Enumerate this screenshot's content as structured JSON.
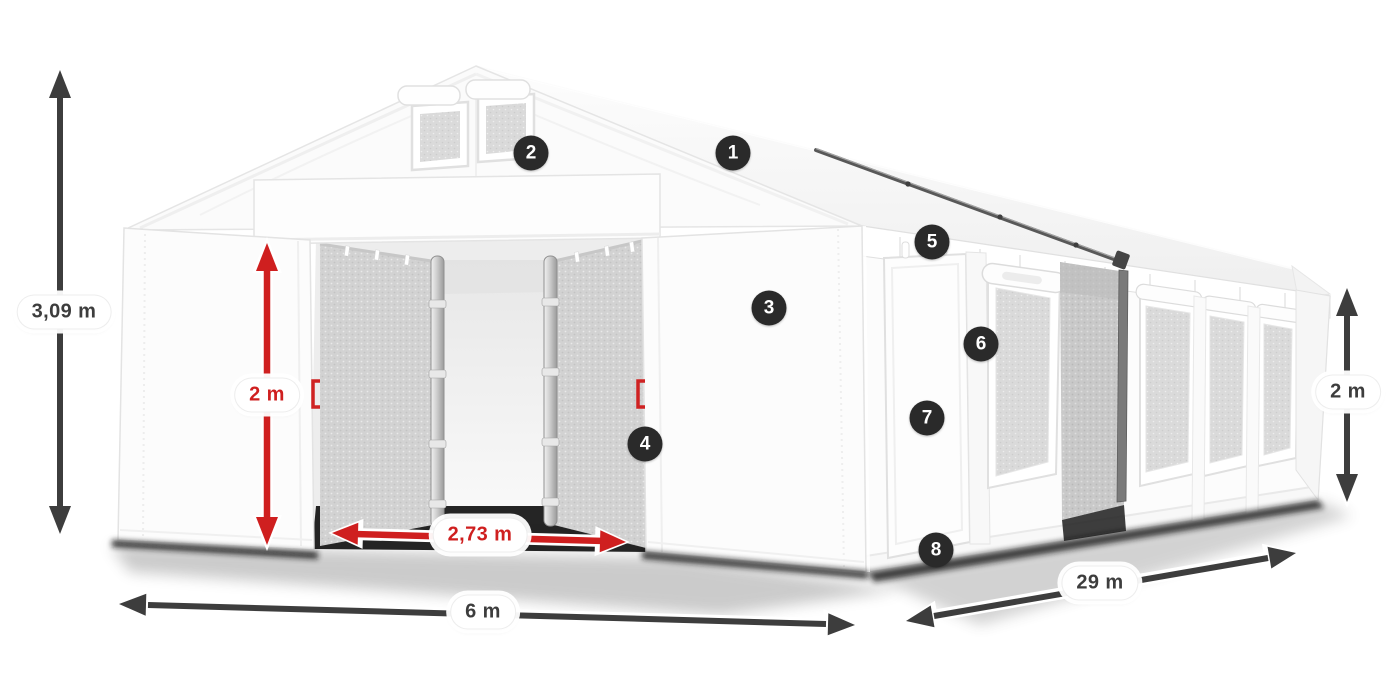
{
  "callouts": [
    {
      "number": "1"
    },
    {
      "number": "2"
    },
    {
      "number": "3"
    },
    {
      "number": "4"
    },
    {
      "number": "5"
    },
    {
      "number": "6"
    },
    {
      "number": "7"
    },
    {
      "number": "8"
    }
  ],
  "dimensions": {
    "ridge_height": {
      "label": "3,09 m"
    },
    "entrance_height": {
      "label": "2 m"
    },
    "entrance_width": {
      "label": "2,73 m"
    },
    "span_width": {
      "label": "6 m"
    },
    "length": {
      "label": "29 m"
    },
    "side_height": {
      "label": "2 m"
    }
  },
  "colors": {
    "dimension_arrow_dark": "#3d3d3d",
    "dimension_arrow_red": "#cf1f1f",
    "badge_background": "#2a2a2a",
    "badge_text": "#ffffff",
    "tent_white": "#fbfbfb",
    "mesh_gray": "#d2d2d2"
  }
}
